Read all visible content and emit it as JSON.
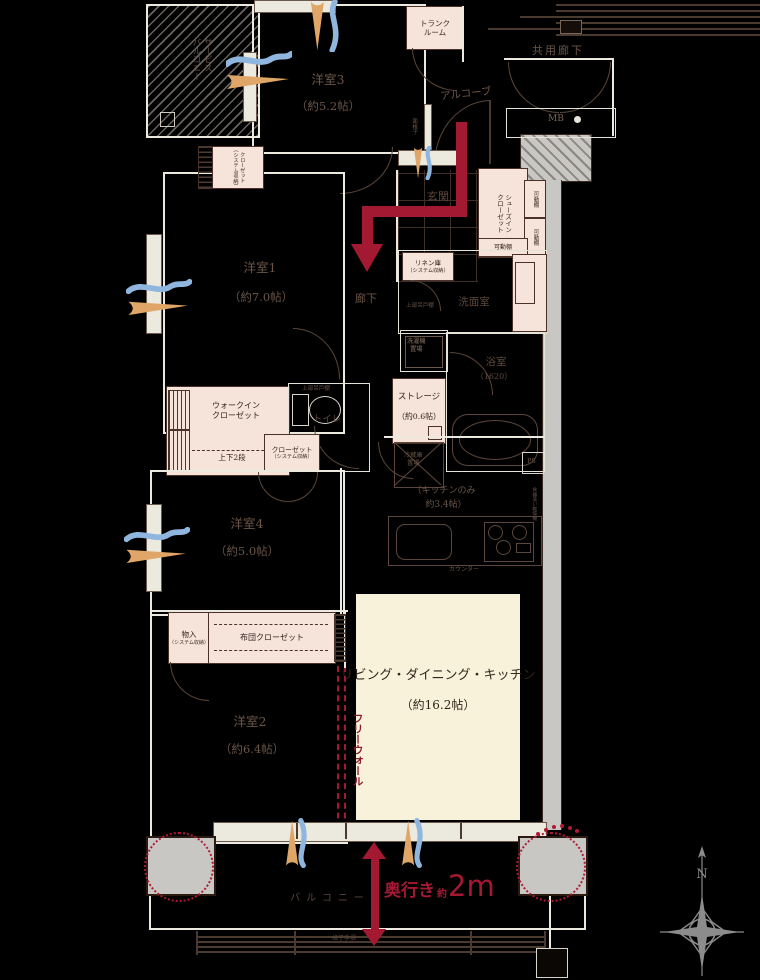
{
  "rooms": {
    "service_balcony": {
      "label1": "サービス",
      "label2": "バルコニー"
    },
    "trunk_room": {
      "label1": "トランク",
      "label2": "ルーム"
    },
    "kyoyo_roka": {
      "label": "共用廊下"
    },
    "mb": {
      "label": "MB"
    },
    "alcove": {
      "label": "アルコーブ"
    },
    "yoshitsu3": {
      "label": "洋室3",
      "size": "（約5.2帖）"
    },
    "yoshitsu1": {
      "label": "洋室1",
      "size": "（約7.0帖）"
    },
    "yoshitsu4": {
      "label": "洋室4",
      "size": "（約5.0帖）"
    },
    "yoshitsu2": {
      "label": "洋室2",
      "size": "（約6.4帖）"
    },
    "ldk": {
      "label": "リビング・ダイニング・キッチン",
      "size": "（約16.2帖）"
    },
    "kitchen": {
      "line1": "（キッチンのみ",
      "line2": "約3.4帖）"
    },
    "genkan": {
      "label": "玄関"
    },
    "roka": {
      "label": "廊下"
    },
    "washroom": {
      "label": "洗面室"
    },
    "bathroom": {
      "label": "浴室",
      "size": "（1620）"
    },
    "toilet": {
      "label": "トイレ"
    },
    "storage": {
      "label": "ストレージ",
      "size": "（約0.6帖）"
    },
    "balcony": {
      "label": "バルコニー"
    }
  },
  "fixtures": {
    "sic1": "シューズイン",
    "sic2": "クローゼット",
    "kadodana": "可動棚",
    "linen1": "リネン庫",
    "sys": "（システム収納）",
    "tsuridana": "上部吊戸棚",
    "sentaku1": "洗濯機",
    "sentaku2": "置場",
    "wic1": "ウォークイン",
    "wic2": "クローゼット",
    "jogedan": "上下2段",
    "closet": "クローゼット",
    "futon": "布団クローゼット",
    "monoire": "物入",
    "reizo1": "冷蔵庫",
    "reizo2": "置場",
    "counter": "カウンター",
    "dishwasher": "食器洗い乾燥機",
    "ps": "PS",
    "koshimado": "面格子"
  },
  "annotations": {
    "free_wall": "フリーウォール",
    "okuyuki": "奥行き",
    "yaku": "約",
    "depth_value": "2m",
    "koshi_tesuri": "格子手摺",
    "north": "N"
  },
  "colors": {
    "crimson": "#a41932",
    "wind_orange": "#dfa667",
    "wind_blue": "#8fb6de",
    "closet_pink": "#f6e3da",
    "ldk_cream": "#f8f2da",
    "wall_white": "#eceadf",
    "concrete_gray": "#c9c7c4",
    "line_brown": "#4a3a30"
  }
}
